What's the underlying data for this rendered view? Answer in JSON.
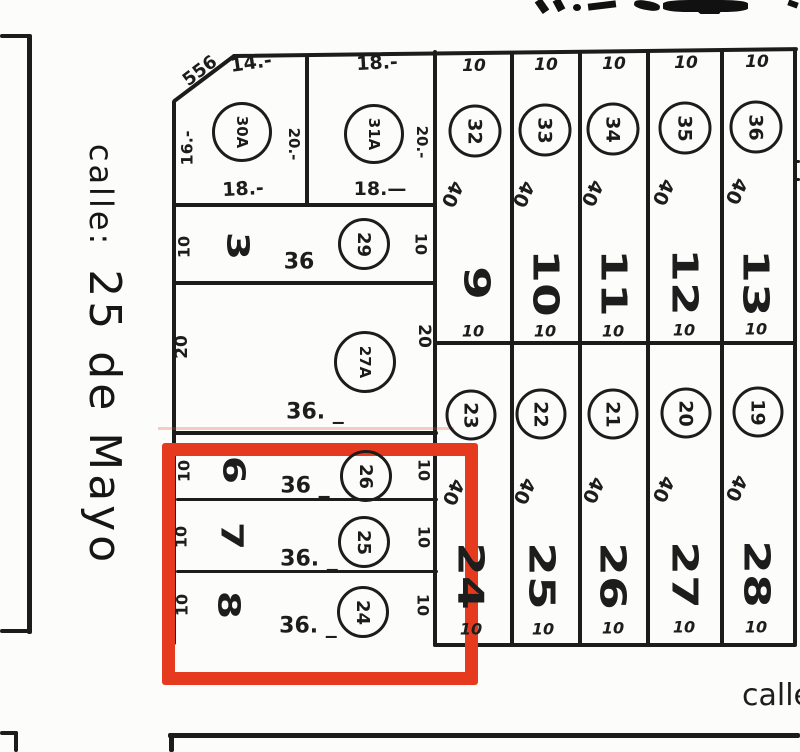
{
  "streets": {
    "left_prefix": "calle:",
    "left_name": "25 de Mayo",
    "bottom": "calle"
  },
  "lot30a": {
    "circle": "30A",
    "slant_dim": "556",
    "top_dim": "14.-",
    "left_dim": "16.-",
    "right_dim": "20.-",
    "bottom_dim": "18.-"
  },
  "lot31a": {
    "circle": "31A",
    "top_dim": "18.-",
    "right_dim": "20.-",
    "bottom_dim": "18.—"
  },
  "row3": {
    "lot": "3",
    "left_dim": "10",
    "frontage": "36",
    "circle": "29",
    "right_dim": "10"
  },
  "lot27a": {
    "circle": "27A",
    "left_dim": "20",
    "right_dim": "20",
    "frontage": "36. _"
  },
  "highlight": {
    "color": "#e63a1e",
    "rows": [
      {
        "lot": "6",
        "left_dim": "10",
        "frontage": "36 _",
        "circle": "26",
        "right_dim": "10"
      },
      {
        "lot": "7",
        "left_dim": "10",
        "frontage": "36. _",
        "circle": "25",
        "right_dim": "10"
      },
      {
        "lot": "8",
        "left_dim": "10",
        "frontage": "36. _",
        "circle": "24",
        "right_dim": "10"
      }
    ]
  },
  "band1": {
    "cols": [
      {
        "top": "10",
        "circle": "32",
        "depth": "40",
        "lot": "9",
        "bottom": "10"
      },
      {
        "top": "10",
        "circle": "33",
        "depth": "40",
        "lot": "10",
        "bottom": "10"
      },
      {
        "top": "10",
        "circle": "34",
        "depth": "40",
        "lot": "11",
        "bottom": "10"
      },
      {
        "top": "10",
        "circle": "35",
        "depth": "40",
        "lot": "12",
        "bottom": "10"
      },
      {
        "top": "10",
        "circle": "36",
        "depth": "40",
        "lot": "13",
        "bottom": "10"
      }
    ]
  },
  "band2": {
    "cols": [
      {
        "circle": "23",
        "depth": "40",
        "lot": "24",
        "bottom": "10"
      },
      {
        "circle": "22",
        "depth": "40",
        "lot": "25",
        "bottom": "10"
      },
      {
        "circle": "21",
        "depth": "40",
        "lot": "26",
        "bottom": "10"
      },
      {
        "circle": "20",
        "depth": "40",
        "lot": "27",
        "bottom": "10"
      },
      {
        "circle": "19",
        "depth": "40",
        "lot": "28",
        "bottom": "10"
      }
    ]
  },
  "colors": {
    "ink": "#1c1c1c",
    "paper": "#fcfcfa",
    "highlight": "#e63a1e"
  }
}
